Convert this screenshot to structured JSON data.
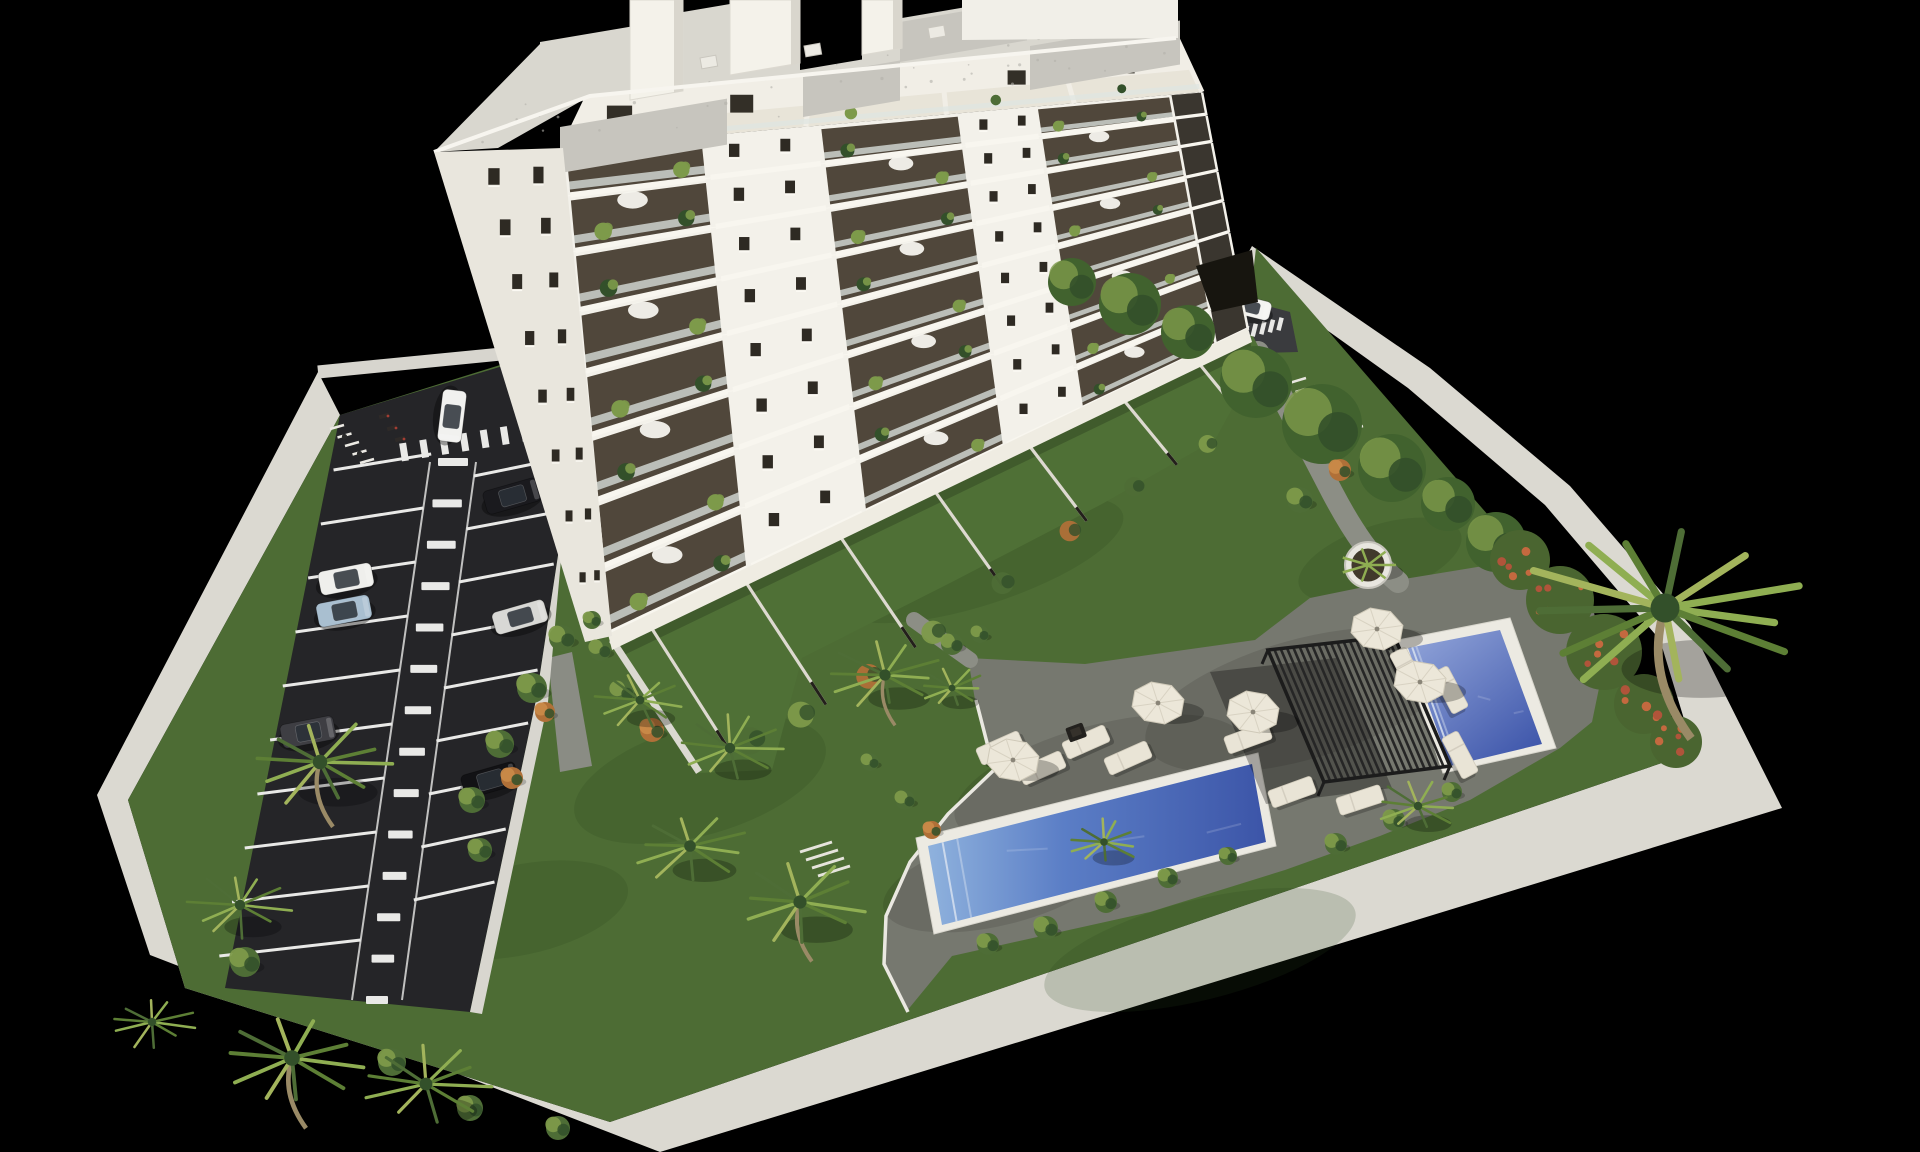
{
  "meta": {
    "title": "Aerial 3D architectural rendering of a white apartment tower with gardens, parking lot and swimming pools on a black background",
    "view": "aerial-axonometric",
    "time_of_day": "daylight"
  },
  "palette": {
    "background": "#000000",
    "wall": "#dbd9d1",
    "sidewalk": "#d8d6cf",
    "lawn": "#4d6c34",
    "lawn_light": "#5f803f",
    "terrace_grass": "#4f7036",
    "asphalt": "#252528",
    "marking": "#e9e9e7",
    "deck": "#76786f",
    "path": "#8c8e85",
    "curb": "#eae8e1",
    "facade": "#f3f1ea",
    "facade_shade": "#e9e6dd",
    "penthouse": "#f1eee6",
    "roof": "#d9d7cf",
    "roof_gravel": "#c7c5be",
    "slab": "#f8f6ef",
    "glazing": "#42382b",
    "railing": "#dfe6e2",
    "window": "#2e2a23",
    "base_strip": "#efece2",
    "pool_coping": "#eceae2",
    "lap_water_shallow": "#8fb2dd",
    "lap_water_deep": "#3c55a8",
    "plunge_water_shallow": "#93a6da",
    "plunge_water_deep": "#3f57ab",
    "pergola": "#262626",
    "umbrella": "#ece7d9",
    "lounger": "#e9e4d6",
    "plant": "#4e6d36",
    "plant_light": "#7d9a4a",
    "plant_dark": "#33502a",
    "plant_accent": "#b07038",
    "palm_light": "#8fae52",
    "palm_dark": "#5d7f35",
    "trunk": "#9a8a66"
  },
  "scene": {
    "building": {
      "label": "apartment-tower",
      "floors": 8,
      "left_window_rows": 8,
      "left_window_cols": [
        0.42,
        0.78
      ],
      "balcony_sections": [
        [
          0.0,
          0.22
        ],
        [
          0.4,
          0.62
        ],
        [
          0.74,
          0.95
        ]
      ],
      "corner_recess": [
        0.95,
        1.0
      ],
      "pillars": [
        0.0,
        0.22,
        0.4,
        0.62,
        0.74,
        0.95,
        1.0
      ],
      "windows_t": [
        0.265,
        0.345,
        0.655,
        0.715
      ],
      "plants_t": [
        0.05,
        0.18,
        0.44,
        0.58,
        0.77,
        0.9
      ],
      "penthouse_windows_t": [
        0.07,
        0.27,
        0.5,
        0.72,
        0.9
      ],
      "penthouse_pillars": [
        0.0,
        0.17,
        0.38,
        0.6,
        0.8,
        1.0
      ],
      "penthouse_plants_t": [
        0.03,
        0.22,
        0.45,
        0.68,
        0.88
      ],
      "roof_chimneys": [
        [
          630,
          683,
          100
        ],
        [
          730,
          800,
          75
        ],
        [
          862,
          902,
          55
        ]
      ],
      "roof_notches": [
        [
          540,
          630,
          42
        ],
        [
          683,
          730,
          12
        ],
        [
          800,
          862,
          70
        ],
        [
          902,
          962,
          18
        ]
      ],
      "roof_patches": [
        [
          560,
          127,
          727,
          46
        ],
        [
          803,
          77,
          900,
          40
        ],
        [
          900,
          22,
          1027,
          40
        ],
        [
          1030,
          46,
          1180,
          44
        ]
      ],
      "roof_speckles": 46
    },
    "parking": {
      "label": "parking-lot",
      "stalls_left": 10,
      "stalls_right": 9,
      "aisle_dashes": 14,
      "top_dashes": 8,
      "entrance_dashes": 6,
      "bike_stands": 5,
      "entrance_stands": 7,
      "cars": [
        {
          "id": "car-white-driving",
          "color": "#f1f1ef",
          "x": 452,
          "y": 416,
          "angle": 97,
          "len": 52,
          "wid": 24
        },
        {
          "id": "car-black-upper",
          "color": "#1a1a1e",
          "x": 512,
          "y": 496,
          "angle": -16,
          "len": 56,
          "wid": 24
        },
        {
          "id": "car-white-parked",
          "color": "#efefec",
          "x": 346,
          "y": 579,
          "angle": -11,
          "len": 54,
          "wid": 24
        },
        {
          "id": "car-light-blue",
          "color": "#a9bfd0",
          "x": 344,
          "y": 611,
          "angle": -11,
          "len": 54,
          "wid": 24
        },
        {
          "id": "car-silver",
          "color": "#d8d8d5",
          "x": 520,
          "y": 617,
          "angle": -16,
          "len": 54,
          "wid": 23
        },
        {
          "id": "car-dark-gray",
          "color": "#3e3e43",
          "x": 308,
          "y": 732,
          "angle": -11,
          "len": 54,
          "wid": 24
        },
        {
          "id": "car-black-lower",
          "color": "#121215",
          "x": 490,
          "y": 780,
          "angle": -16,
          "len": 56,
          "wid": 24
        },
        {
          "id": "car-white-entrance",
          "color": "#f4f4f1",
          "x": 1250,
          "y": 307,
          "angle": 14,
          "len": 42,
          "wid": 19
        }
      ]
    },
    "pools": [
      {
        "id": "lap-pool",
        "coping": [
          [
            916,
            838
          ],
          [
            1258,
            753
          ],
          [
            1276,
            846
          ],
          [
            934,
            934
          ]
        ],
        "water": [
          [
            928,
            846
          ],
          [
            1252,
            764
          ],
          [
            1266,
            842
          ],
          [
            942,
            925
          ]
        ],
        "gradient": "gradLap"
      },
      {
        "id": "plunge-pool",
        "coping": [
          [
            1398,
            640
          ],
          [
            1510,
            618
          ],
          [
            1556,
            748
          ],
          [
            1443,
            773
          ]
        ],
        "water": [
          [
            1408,
            648
          ],
          [
            1500,
            630
          ],
          [
            1542,
            744
          ],
          [
            1450,
            766
          ]
        ],
        "gradient": "gradPlunge"
      }
    ],
    "amenities": {
      "pergola": {
        "corners": [
          [
            1268,
            650
          ],
          [
            1394,
            636
          ],
          [
            1450,
            766
          ],
          [
            1324,
            782
          ]
        ],
        "slats": 20,
        "shadow_offset": [
          -58,
          22
        ]
      },
      "umbrellas": [
        [
          1013,
          760
        ],
        [
          1158,
          703
        ],
        [
          1253,
          712
        ],
        [
          1377,
          629
        ],
        [
          1420,
          682
        ]
      ],
      "loungers": [
        [
          1000,
          748,
          -24
        ],
        [
          1042,
          768,
          -24
        ],
        [
          1086,
          742,
          -24
        ],
        [
          1128,
          758,
          -24
        ],
        [
          1248,
          738,
          -20
        ],
        [
          1292,
          792,
          -20
        ],
        [
          1360,
          800,
          -18
        ],
        [
          1408,
          671,
          62
        ],
        [
          1450,
          690,
          62
        ],
        [
          1460,
          755,
          62
        ]
      ],
      "planter": {
        "x": 1368,
        "y": 565,
        "r": 23
      },
      "firepit": {
        "x": 1076,
        "y": 732
      },
      "garden_steps": {
        "x": 800,
        "y": 852,
        "count": 4
      }
    },
    "vegetation": {
      "palms": [
        [
          320,
          762,
          72,
          1
        ],
        [
          292,
          1058,
          78,
          1
        ],
        [
          152,
          1022,
          42,
          0
        ],
        [
          240,
          905,
          52,
          0
        ],
        [
          426,
          1084,
          64,
          0
        ],
        [
          640,
          700,
          44,
          0
        ],
        [
          730,
          748,
          52,
          0
        ],
        [
          885,
          675,
          56,
          1
        ],
        [
          800,
          902,
          66,
          1
        ],
        [
          690,
          846,
          58,
          0
        ],
        [
          1665,
          608,
          145,
          1
        ],
        [
          1418,
          806,
          42,
          0
        ],
        [
          1104,
          842,
          38,
          0
        ],
        [
          952,
          688,
          34,
          0
        ]
      ],
      "shrubs": [
        [
          562,
          638,
          13,
          0
        ],
        [
          532,
          688,
          15,
          0
        ],
        [
          500,
          744,
          14,
          0
        ],
        [
          472,
          800,
          13,
          0
        ],
        [
          512,
          778,
          11,
          1
        ],
        [
          545,
          712,
          10,
          1
        ],
        [
          480,
          850,
          12,
          0
        ],
        [
          600,
          650,
          11,
          0
        ],
        [
          622,
          692,
          12,
          0
        ],
        [
          652,
          730,
          12,
          1
        ],
        [
          592,
          620,
          9,
          0
        ],
        [
          952,
          644,
          11,
          0
        ],
        [
          980,
          634,
          9,
          0
        ],
        [
          988,
          944,
          11,
          0
        ],
        [
          1046,
          928,
          12,
          0
        ],
        [
          1106,
          902,
          11,
          0
        ],
        [
          1168,
          878,
          10,
          0
        ],
        [
          1228,
          856,
          9,
          0
        ],
        [
          1336,
          844,
          11,
          0
        ],
        [
          1394,
          820,
          11,
          0
        ],
        [
          1452,
          792,
          10,
          0
        ],
        [
          1300,
          500,
          13,
          0
        ],
        [
          1340,
          470,
          11,
          1
        ],
        [
          245,
          962,
          15,
          0
        ],
        [
          392,
          1062,
          14,
          0
        ],
        [
          470,
          1108,
          13,
          0
        ],
        [
          558,
          1128,
          12,
          0
        ],
        [
          905,
          800,
          10,
          0
        ],
        [
          870,
          762,
          9,
          0
        ],
        [
          932,
          830,
          9,
          1
        ]
      ],
      "hedge_trees": [
        [
          1072,
          282,
          24
        ],
        [
          1130,
          304,
          31
        ],
        [
          1188,
          332,
          27
        ],
        [
          1256,
          382,
          36
        ],
        [
          1322,
          424,
          40
        ],
        [
          1392,
          468,
          34
        ],
        [
          1448,
          504,
          27
        ],
        [
          1496,
          542,
          30
        ]
      ],
      "flower_shrubs": [
        [
          1520,
          560,
          30
        ],
        [
          1560,
          600,
          34
        ],
        [
          1604,
          652,
          38
        ],
        [
          1644,
          704,
          30
        ],
        [
          1676,
          742,
          26
        ]
      ],
      "terrace_shrub_s": [
        0.08,
        0.16,
        0.27,
        0.38,
        0.5,
        0.62,
        0.73,
        0.85,
        0.94
      ],
      "lawn_patches": [
        [
          700,
          780,
          130,
          55,
          -16
        ],
        [
          980,
          560,
          150,
          45,
          -18
        ],
        [
          520,
          910,
          110,
          45,
          -12
        ],
        [
          1380,
          560,
          85,
          35,
          -18
        ],
        [
          860,
          500,
          90,
          35,
          -18
        ],
        [
          1200,
          950,
          160,
          50,
          -14
        ]
      ]
    }
  }
}
